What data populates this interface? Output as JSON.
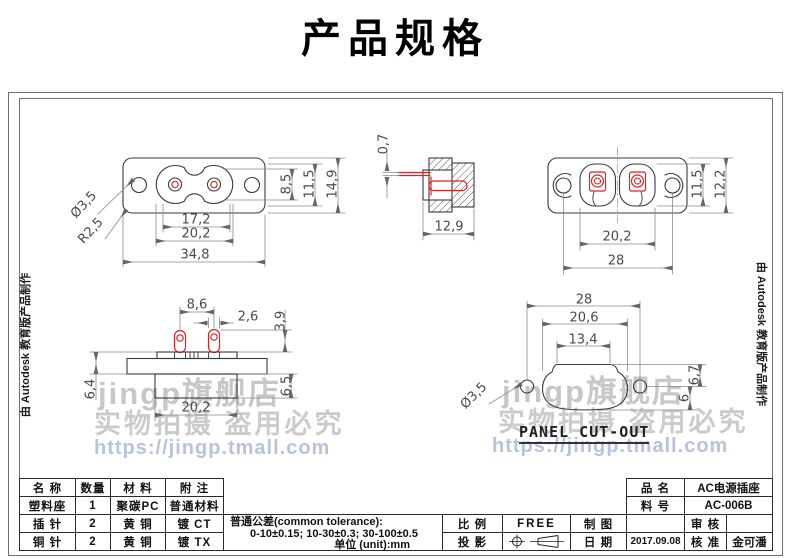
{
  "page_title": "产品规格",
  "edge_note": "由 Autodesk 教育版产品制作",
  "watermark": {
    "store": "jingp旗舰店",
    "notice": "实物拍摄 盗用必究",
    "url": "https://jingp.tmall.com"
  },
  "views": {
    "front": {
      "dia": "Ø3,5",
      "radius": "R2,5",
      "recess_h": "8,5",
      "inner_h": "11,5",
      "total_h": "14,9",
      "pin_span": "17,2",
      "recess_w": "20,2",
      "total_w": "34,8"
    },
    "section": {
      "pin_t": "0,7",
      "depth": "12,9"
    },
    "rear": {
      "inner_h": "11,5",
      "total_h": "12,2",
      "recess_w": "20,2",
      "hole_span": "28"
    },
    "side": {
      "pin_span": "8,6",
      "pin_w": "2,6",
      "pin_h": "3,9",
      "flange_h": "6,4",
      "body_h": "6,5",
      "body_w": "20,2"
    },
    "cutout": {
      "hole_span": "28",
      "outer_w": "20,6",
      "top_w": "13,4",
      "dia": "Ø3,5",
      "right_h1": "6,7",
      "right_h2": "6",
      "caption": "PANEL CUT-OUT"
    }
  },
  "title_block": {
    "parts_table": {
      "headers": [
        "名 称",
        "数量",
        "材 料",
        "附 注"
      ],
      "rows": [
        {
          "name": "塑料座",
          "qty": "1",
          "material": "聚碳PC",
          "note": "普通材料"
        },
        {
          "name": "插 针",
          "qty": "2",
          "material": "黄 铜",
          "note": "镀 CT"
        },
        {
          "name": "铜 针",
          "qty": "2",
          "material": "黄 铜",
          "note": "镀 TX"
        }
      ]
    },
    "tolerance": {
      "line1": "普通公差(common tolerance):",
      "line2": "0-10±0.15; 10-30±0.3; 30-100±0.5",
      "line3": "单位 (unit):mm"
    },
    "scale_label": "比 例",
    "scale_value": "FREE",
    "projection_label": "投 影",
    "drawn_label": "制 图",
    "drawn_value": "",
    "date_label": "日 期",
    "date_value": "2017.09.08",
    "product_label": "品 名",
    "product_value": "AC电源插座",
    "part_no_label": "料 号",
    "part_no_value": "AC-006B",
    "review_label": "审 核",
    "review_value": "",
    "approve_label": "核 准",
    "approve_value": "金可潘"
  }
}
